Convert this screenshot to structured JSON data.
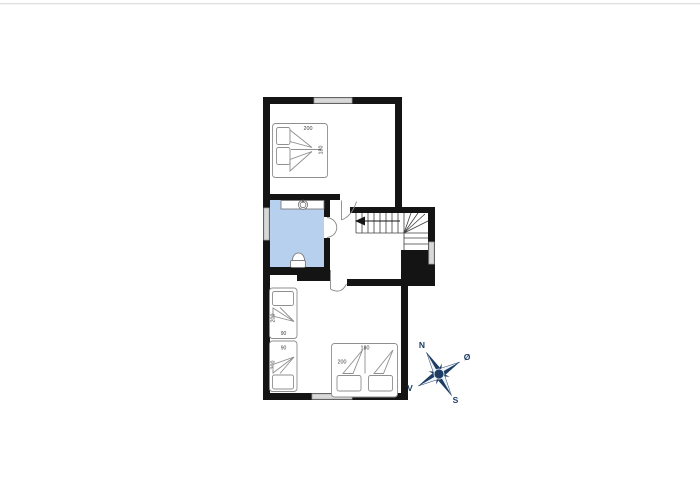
{
  "colors": {
    "wall": "#141414",
    "window_fill": "#d8d8d8",
    "window_stroke": "#9a9a9a",
    "bathroom_fill": "#b6d0ee",
    "fixture_stroke": "#6f6f6f",
    "bed_stroke": "#8f8f8f",
    "label_text": "#3c3c3c",
    "stair_line": "#3f3f3f",
    "arrow": "#161616",
    "door_stroke": "#8a8a8a",
    "compass_navy": "#1c3c63",
    "compass_light": "#eef3f9",
    "top_rule": "#dedede"
  },
  "beds": {
    "double_top": {
      "length": "200",
      "width": "180"
    },
    "single_upper": {
      "length": "200",
      "width": "90"
    },
    "single_lower": {
      "length": "200",
      "width": "90"
    },
    "double_bottom": {
      "length": "200",
      "width": "180"
    }
  },
  "compass": {
    "north": "N",
    "east": "Ø",
    "south": "S",
    "west": "V"
  }
}
